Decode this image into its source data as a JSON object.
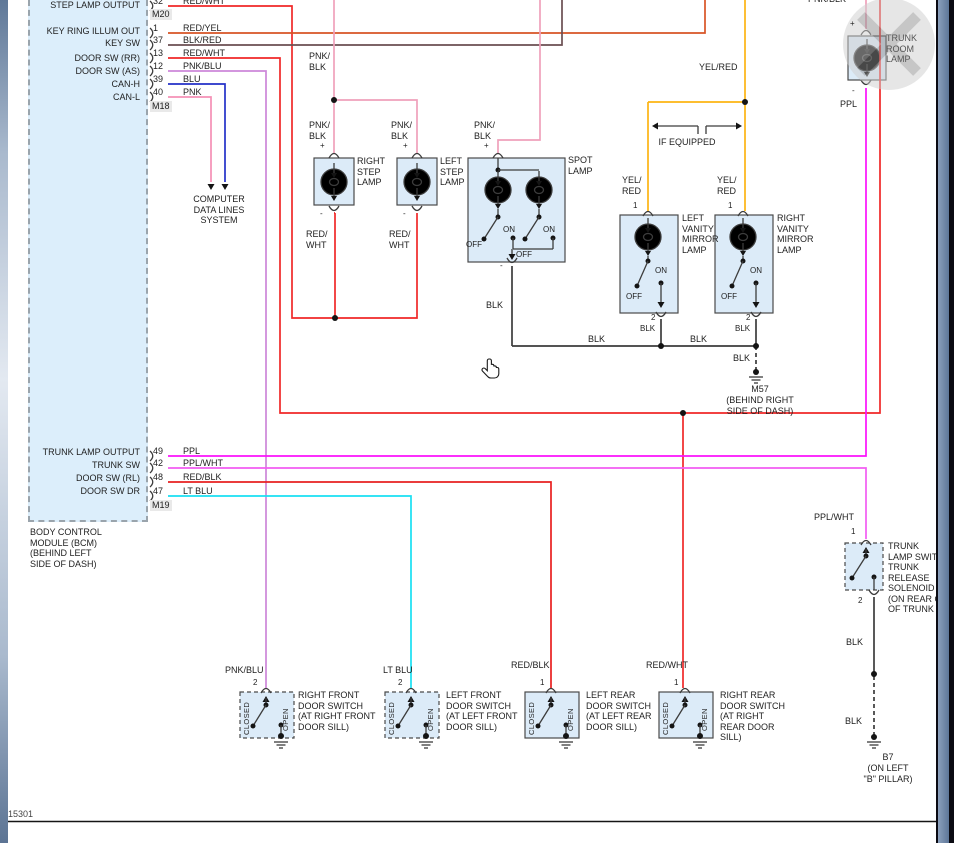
{
  "palette": {
    "wire_red": "#f02828",
    "wire_red_yel": "#d85426",
    "wire_blk_red": "#6b4f52",
    "wire_pnk_blu": "#cd87d9",
    "wire_blu": "#2431c8",
    "wire_pnk": "#f590b6",
    "wire_pnk_blk": "#efa1bb",
    "wire_ppl": "#fb12fb",
    "wire_ppl_wht": "#f25cf2",
    "wire_red_blk": "#e82020",
    "wire_lt_blu": "#19dff2",
    "wire_yel_red": "#fdb413",
    "wire_blk": "#3c3c3c",
    "panel_fill": "#dceefb",
    "box_fill": "#dcebf8"
  },
  "bcm": {
    "label_step_lamp_output": "STEP LAMP OUTPUT",
    "label_key_ring": "KEY RING ILLUM OUT",
    "label_key_sw": "KEY SW",
    "label_door_sw_rr": "DOOR SW (RR)",
    "label_door_sw_as": "DOOR SW (AS)",
    "label_can_h": "CAN-H",
    "label_can_l": "CAN-L",
    "label_trunk_lamp_output": "TRUNK LAMP OUTPUT",
    "label_trunk_sw": "TRUNK SW",
    "label_door_sw_rl": "DOOR SW (RL)",
    "label_door_sw_dr": "DOOR SW DR",
    "conn_m20": "M20",
    "conn_m18": "M18",
    "conn_m19": "M19",
    "pin32": "32",
    "pin1": "1",
    "pin37": "37",
    "pin13": "13",
    "pin12": "12",
    "pin39": "39",
    "pin40": "40",
    "pin49": "49",
    "pin42": "42",
    "pin48": "48",
    "pin47": "47",
    "name": "BODY CONTROL\nMODULE (BCM)\n(BEHIND LEFT\nSIDE OF DASH)"
  },
  "wires": {
    "red_wht": "RED/WHT",
    "red_yel": "RED/YEL",
    "blk_red": "BLK/RED",
    "pnk_blu": "PNK/BLU",
    "blu": "BLU",
    "pnk": "PNK",
    "ppl": "PPL",
    "ppl_wht": "PPL/WHT",
    "red_blk": "RED/BLK",
    "lt_blu": "LT BLU",
    "yel_red": "YEL/RED",
    "blk": "BLK",
    "pnk_blk_2l": "PNK/\nBLK",
    "red_wht_2l": "RED/\nWHT",
    "yel_red_2l": "YEL/\nRED",
    "pnk_blk_top": "PNK/BLK"
  },
  "components": {
    "right_step_lamp": "RIGHT\nSTEP\nLAMP",
    "left_step_lamp": "LEFT\nSTEP\nLAMP",
    "spot_lamp": "SPOT\nLAMP",
    "left_vanity": "LEFT\nVANITY\nMIRROR\nLAMP",
    "right_vanity": "RIGHT\nVANITY\nMIRROR\nLAMP",
    "trunk_room_lamp": "TRUNK\nROOM\nLAMP",
    "trunk_switch": "TRUNK\nLAMP SWIT\nTRUNK\nRELEASE\nSOLENOID\n(ON REAR O\nOF TRUNK",
    "computer_data": "COMPUTER\nDATA LINES\nSYSTEM",
    "if_equipped": "IF EQUIPPED",
    "sw_rf": "RIGHT FRONT\nDOOR SWITCH\n(AT RIGHT FRONT\nDOOR SILL)",
    "sw_lf": "LEFT FRONT\nDOOR SWITCH\n(AT LEFT FRONT\nDOOR SILL)",
    "sw_lr": "LEFT REAR\nDOOR SWITCH\n(AT LEFT REAR\nDOOR SILL)",
    "sw_rr": "RIGHT REAR\nDOOR SWITCH\n(AT RIGHT\nREAR DOOR\nSILL)"
  },
  "annotations": {
    "on": "ON",
    "off": "OFF",
    "open": "OPEN",
    "closed": "CLOSED",
    "plus": "+",
    "minus": "-",
    "pin1": "1",
    "pin2": "2",
    "m57": "M57",
    "m57_loc": "(BEHIND RIGHT\nSIDE OF DASH)",
    "b7": "B7",
    "b7_loc": "(ON LEFT\n\"B\" PILLAR)",
    "doc_id": "215301"
  }
}
